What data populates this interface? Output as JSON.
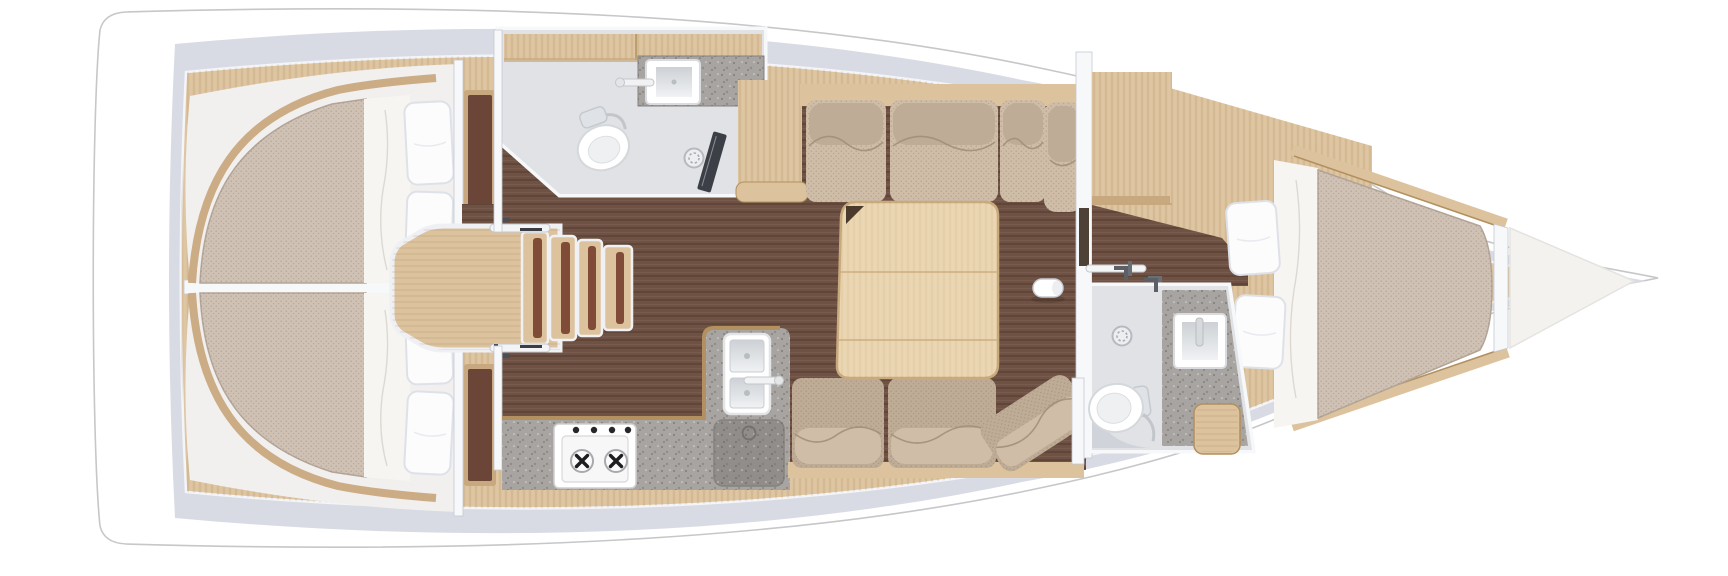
{
  "meta": {
    "image_type": "rendered top-down floor plan",
    "subject": "sailing yacht interior layout, bow pointing right, stern on the left",
    "visible_text": "none"
  },
  "colors": {
    "hull_fill": "#ffffff",
    "hull_outline": "#c6c7c9",
    "rim": "#d8dbe4",
    "rim_light": "#f4f5f9",
    "deck_wood": "#dcc39e",
    "deck_wood_dark": "#c8a87e",
    "wood_edge": "#b2905f",
    "floor_dark": "#6f5244",
    "cabin_floor": "#f1f0ee",
    "mattress": "#cfc1b4",
    "mattress_edge": "#b3a597",
    "sheet": "#f6f5f2",
    "pillow": "#fcfcfd",
    "pillow_shade": "#dfe1e8",
    "wall": "#f7f8fa",
    "wall_edge": "#c5c9d1",
    "sofa": "#cfbda8",
    "sofa_dark": "#bfac96",
    "sofa_seam": "#a08d77",
    "table_wood": "#e9d5b0",
    "table_edge": "#c9aa7d",
    "counter": "#a8a4a1",
    "counter_dark": "#918d8a",
    "bath_floor": "#e0e2e6",
    "bath_floor_dark": "#ccd0d7",
    "fixture": "#ffffff",
    "metal": "#9aa0a8",
    "step_stripe": "#804c38",
    "dark_panel": "#3c4046"
  },
  "layout": {
    "orientation": {
      "bow": "right",
      "stern": "left"
    },
    "rooms": [
      {
        "id": "aft-cabin-port",
        "position": "left-top",
        "features": [
          "double-berth",
          "white-sheet-band",
          "2-pillows",
          "wardrobe"
        ]
      },
      {
        "id": "aft-cabin-starboard",
        "position": "left-bottom",
        "features": [
          "double-berth",
          "white-sheet-band",
          "2-pillows",
          "wardrobe"
        ]
      },
      {
        "id": "aft-head",
        "position": "center-top",
        "features": [
          "toilet",
          "square-sink",
          "faucet",
          "shower-drain",
          "dark-shower-panel",
          "overhead-lockers"
        ]
      },
      {
        "id": "companionway",
        "position": "center",
        "features": [
          "landing-platform",
          "4-steps",
          "2-grab-rails"
        ]
      },
      {
        "id": "galley",
        "position": "center-bottom",
        "features": [
          "2-burner-stove",
          "double-sink",
          "faucet",
          "round-hatch",
          "l-shaped-worktop"
        ]
      },
      {
        "id": "salon",
        "position": "center-right",
        "features": [
          "u-shaped-settee",
          "folding-table-with-notch",
          "compression-post"
        ]
      },
      {
        "id": "forward-head",
        "position": "right-bottom",
        "features": [
          "toilet",
          "square-sink",
          "faucet",
          "shower-drain",
          "wood-seat",
          "diagonal-wall"
        ]
      },
      {
        "id": "forward-cabin",
        "position": "right",
        "features": [
          "v-berth",
          "white-sheet-band",
          "2-pillows",
          "wardrobe",
          "overhead-shelf",
          "2-grab-rails"
        ]
      },
      {
        "id": "anchor-locker",
        "position": "bow-tip",
        "features": []
      }
    ],
    "counts": {
      "cabins": 3,
      "heads": 2,
      "toilets": 2,
      "sinks": 3,
      "shower_drains": 2,
      "berth_pillows": 6,
      "stove_burners": 2,
      "companionway_steps": 4,
      "settee_cushions": 7
    }
  }
}
